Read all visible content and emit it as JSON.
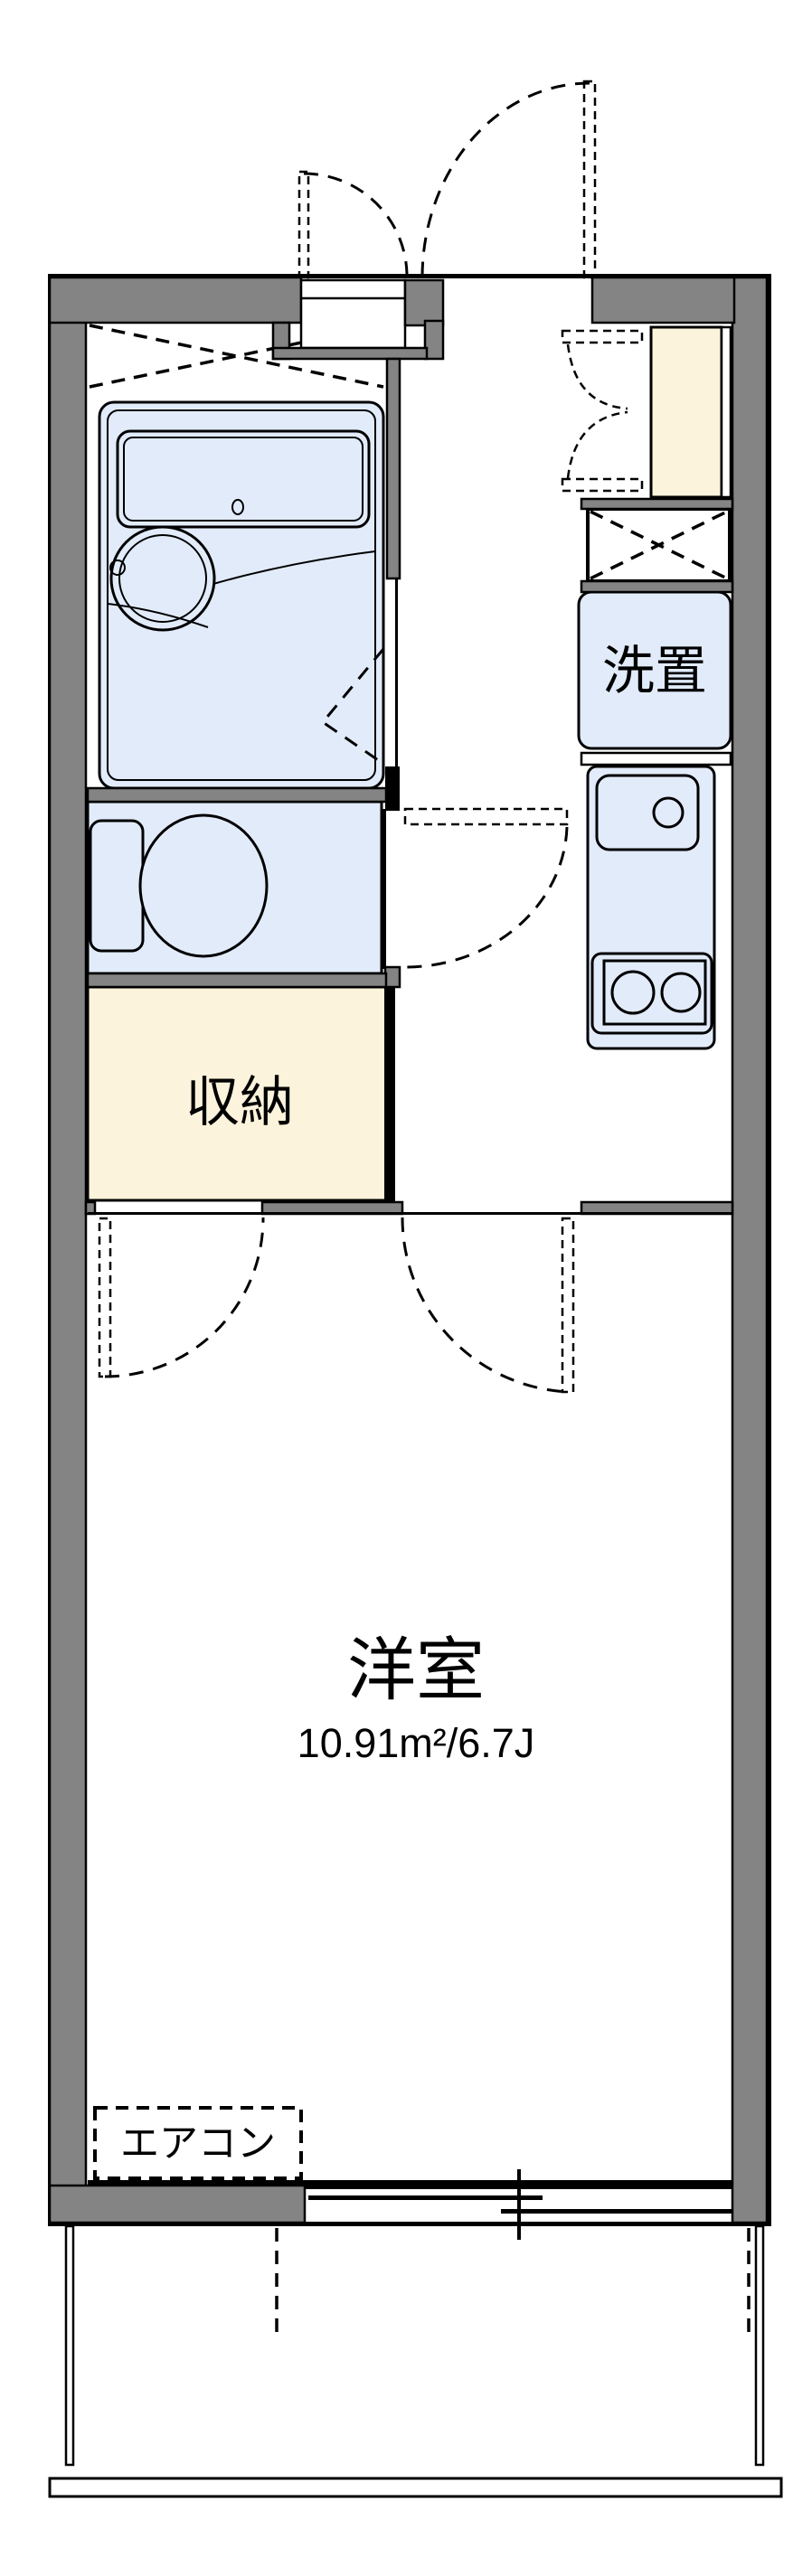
{
  "rooms": {
    "western_room": {
      "label": "洋室",
      "area": "10.91m²/6.7J"
    },
    "storage": {
      "label": "収納"
    },
    "laundry_place": {
      "label": "洗置"
    },
    "air_conditioner": {
      "label": "エアコン"
    }
  },
  "colors": {
    "wall_gray": "#848484",
    "fixture_blue": "#e2ebfa",
    "floor_cream": "#fcf3dc",
    "line_black": "#000000",
    "background": "#ffffff"
  }
}
